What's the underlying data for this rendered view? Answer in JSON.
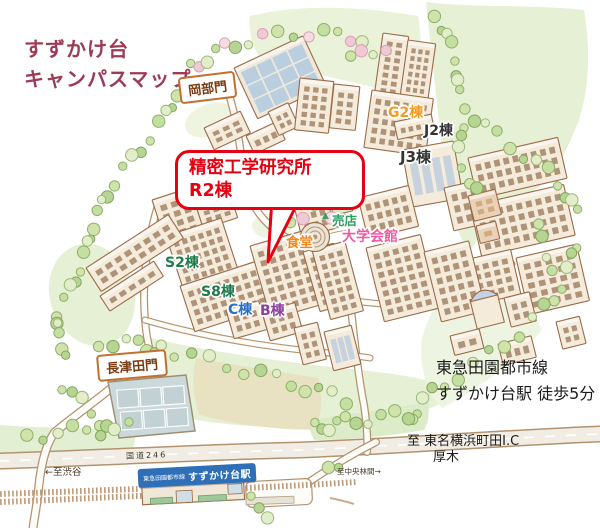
{
  "title": {
    "line1": "すずかけ台",
    "line2": "キャンパスマップ"
  },
  "callout": {
    "line1": "精密工学研究所",
    "line2": "R2棟"
  },
  "gates": {
    "okabe": "岡部門",
    "nagatsuta": "長津田門"
  },
  "buildings": {
    "g2": "G2棟",
    "j2": "J2棟",
    "j3": "J3棟",
    "s2": "S2棟",
    "s8": "S8棟",
    "c": "C棟",
    "b": "B棟",
    "shop": "売店",
    "cafeteria": "食堂",
    "union": "大学会館"
  },
  "access": {
    "line1": "東急田園都市線",
    "line2": "すずかけ台駅 徒歩5分"
  },
  "roads": {
    "route246": "国道246",
    "to_shibuya": "←至渋谷",
    "to_chuorinkan": "至中央林間→",
    "to_tomei": "至 東名横浜町田I.C",
    "to_atsugi": "厚木"
  },
  "station": {
    "line": "東急田園都市線",
    "name": "すずかけ台駅"
  },
  "icons": {
    "shop_tree_icon": "▲"
  },
  "colors": {
    "accent_red": "#e60012",
    "title_maroon": "#9d3a55",
    "gate_brown": "#7a3b10",
    "gate_border": "#c2702e",
    "g2_orange": "#f59a1e",
    "s_green": "#1f7a4c",
    "shop_green": "#2ba05f",
    "cafeteria_orange": "#f5871e",
    "union_pink": "#ef5ba1",
    "c_blue": "#2b6fc5",
    "b_purple": "#8d3f9e",
    "station_blue": "#2f6fb7",
    "building_text_black": "#333333"
  }
}
